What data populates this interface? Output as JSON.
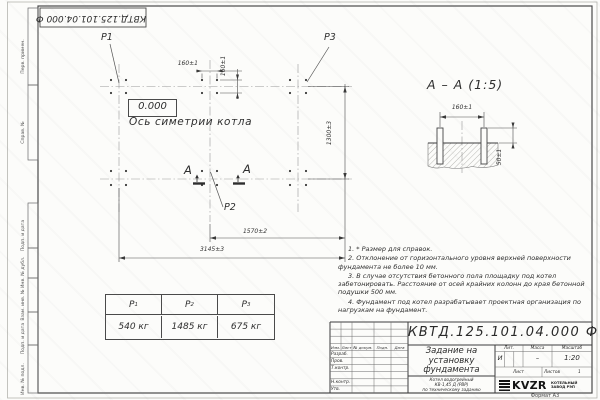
{
  "top_stamp": {
    "text": "КВТД.125.101.04.000 Ф"
  },
  "margin_labels": {
    "perv": "Перв. примен.",
    "sprav": "Справ. №",
    "podp1": "Подп. и дата",
    "inv_dubl": "Инв. № дубл.",
    "vzam": "Взам. инв. №",
    "podp2": "Подп. и дата",
    "inv_podl": "Инв. № подл."
  },
  "plan": {
    "point_labels": {
      "p1": "P1",
      "p2": "P2",
      "p3": "P3"
    },
    "level_mark": "0.000",
    "axis_label": "Ось симетрии котла",
    "section_letter": "А",
    "dimensions": {
      "bolt_spacing_h": "160±1",
      "bolt_spacing_v": "160±1",
      "width": "1300±3",
      "half_length": "1570±2",
      "total_length": "3145±3"
    }
  },
  "section_view": {
    "title": "А – А (1:5)",
    "dim_spacing": "160±1",
    "dim_height": "50±1"
  },
  "notes": [
    "1. * Размер для справок.",
    "2. Отклонение от горизонтального уровня верхней поверхности фундамента не более 10 мм.",
    "3. В случае отсутствия бетонного пола площадку под котел забетонировать. Расстояние от осей крайних колонн до края бетонной подушки 500 мм.",
    "4. Фундамент под котел разрабатывает проектная организация по нагрузкам на фундамент."
  ],
  "load_table": {
    "columns": [
      {
        "name": "P",
        "sub": "1"
      },
      {
        "name": "P",
        "sub": "2"
      },
      {
        "name": "P",
        "sub": "3"
      }
    ],
    "values": [
      "540 кг",
      "1485 кг",
      "675 кг"
    ]
  },
  "title_block": {
    "doc_number": "КВТД.125.101.04.000  Ф",
    "title_lines": [
      "Задание на",
      "установку",
      "фундамента"
    ],
    "product_lines": [
      "Котел водогрейный",
      "КВ-1,45 Д (РВР)",
      "по техническому заданию"
    ],
    "header_cols": {
      "izm": "Изм.",
      "list": "Лист",
      "doc": "№ докум.",
      "podp": "Подп.",
      "data": "Дата"
    },
    "rows": {
      "razrab": "Разраб.",
      "prov": "Пров.",
      "tkontr": "Т.контр.",
      "nkontr": "Н.контр.",
      "utv": "Утв."
    },
    "lit_label": "Лит.",
    "massa_label": "Масса",
    "masshtab_label": "Масштаб",
    "lit_value": "И",
    "massa_value": "–",
    "masshtab_value": "1:20",
    "list_label": "Лист",
    "listov_label": "Листов",
    "listov_value": "1",
    "logo": {
      "text": "KVZR",
      "subtitle_lines": [
        "КОТЕЛЬНЫЙ",
        "ЗАВОД РЭП"
      ]
    }
  },
  "format_label": "Формат А3",
  "colors": {
    "line": "#4a4a4a",
    "light_line": "#999999",
    "paper": "#fcfcfa"
  }
}
